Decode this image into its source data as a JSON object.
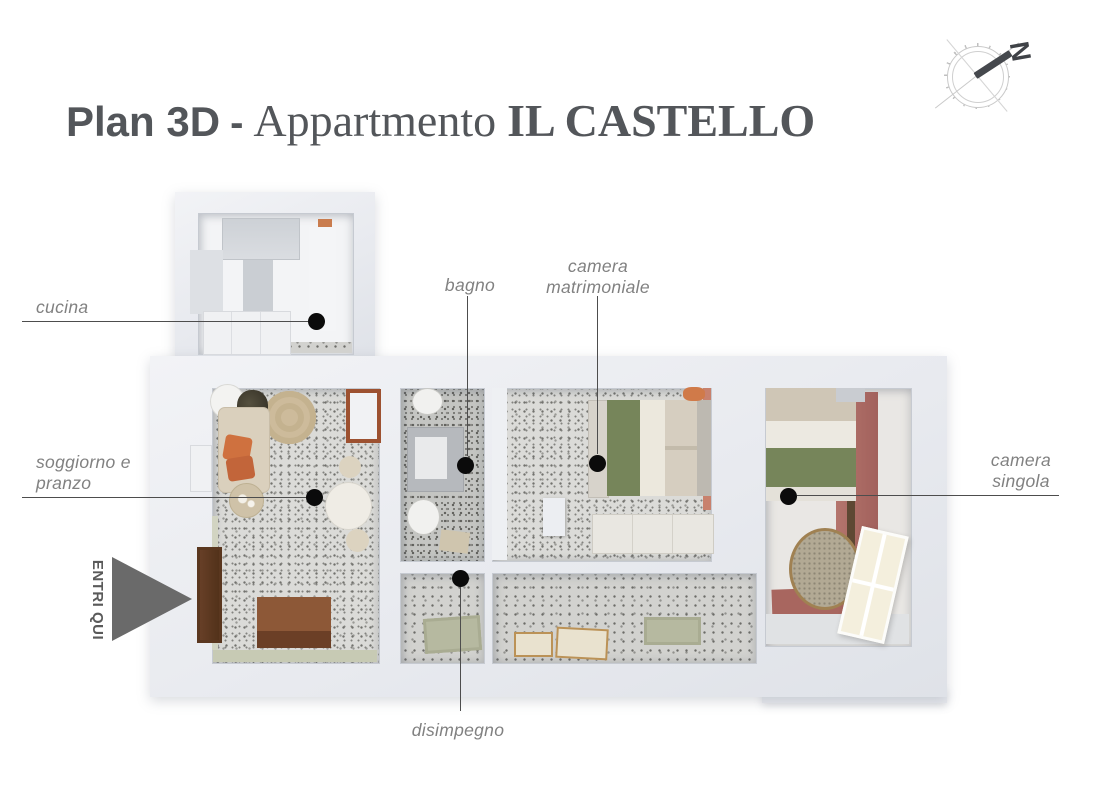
{
  "title": {
    "plan": "Plan 3D",
    "separator": "-",
    "apartment": "Appartmento",
    "apartment_name": "IL CASTELLO"
  },
  "compass": {
    "north": "N"
  },
  "entry": {
    "label": "ENTRI QUI"
  },
  "rooms": {
    "cucina": {
      "label": "cucina"
    },
    "soggiorno": {
      "label": "soggiorno e\npranzo"
    },
    "bagno": {
      "label": "bagno"
    },
    "camera_matrimoniale": {
      "label": "camera\nmatrimoniale"
    },
    "camera_singola": {
      "label": "camera\nsingola"
    },
    "disimpegno": {
      "label": "disimpegno"
    }
  },
  "colors": {
    "title_text": "#53565a",
    "label_text": "#818181",
    "annotation_line": "#4d4d4d",
    "marker_dot": "#0b0b0b",
    "entry_arrow": "#6a6a6a",
    "wall": "#e9ebf0",
    "terrazzo_floor": "#dbdbd8",
    "accent_wall_salmon": "#c8816d",
    "mauve_floor": "#a8665f",
    "green_blanket": "#76855a",
    "sofa_beige": "#dad0bd",
    "orange_cushion": "#cf713f",
    "dark_wood": "#5e3a26",
    "rug_tan": "#cdbb9b"
  }
}
